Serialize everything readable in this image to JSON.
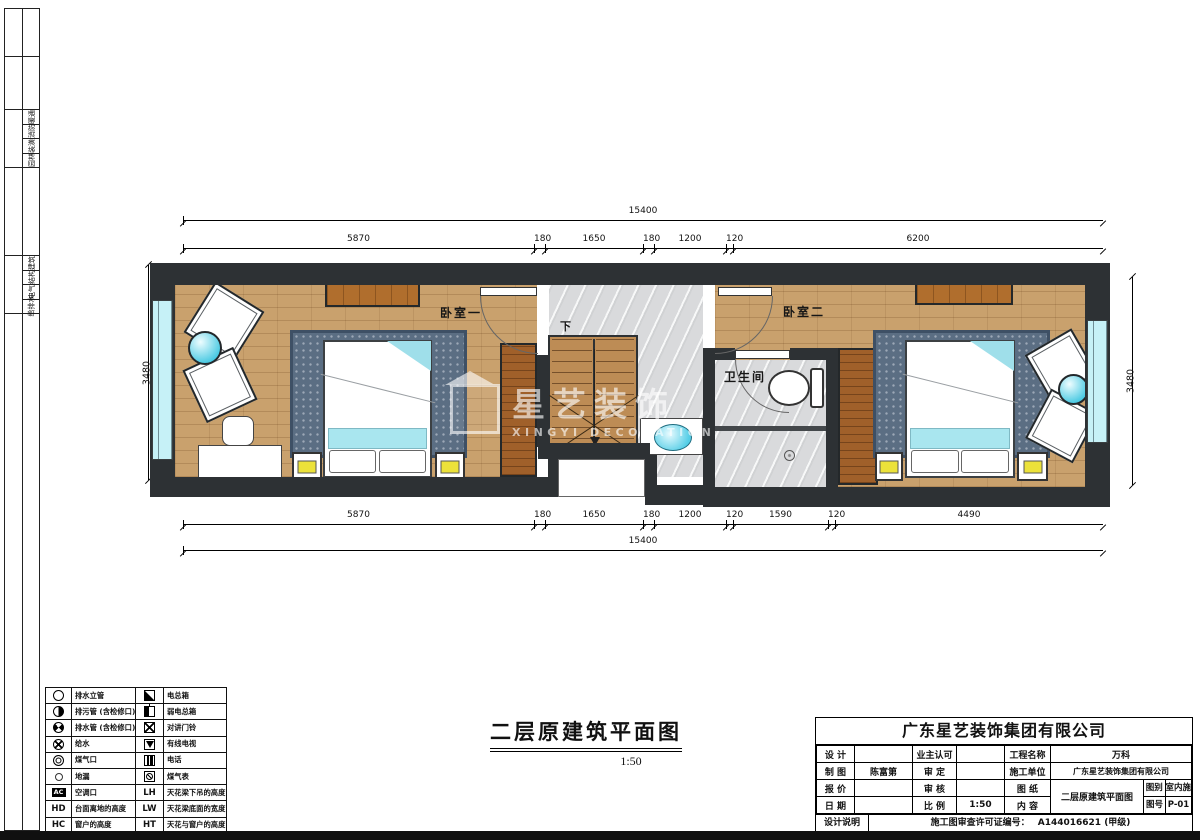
{
  "sheet": {
    "disciplines_top": [
      "暖通",
      "消防",
      "装潢",
      "园林"
    ],
    "disciplines_bottom": [
      "建筑",
      "结构",
      "电气",
      "给排水"
    ]
  },
  "plan": {
    "room1": "卧室一",
    "room2": "卧室二",
    "bath": "卫生间",
    "stair_down": "下",
    "dims": {
      "top_overall": "15400",
      "top_segments": [
        "5870",
        "180",
        "1650",
        "180",
        "1200",
        "120",
        "6200"
      ],
      "bottom_segments": [
        "5870",
        "180",
        "1650",
        "180",
        "1200",
        "120",
        "1590",
        "120",
        "4490"
      ],
      "bottom_overall": "15400",
      "left": "3480",
      "right": "3480"
    }
  },
  "watermark": {
    "cn": "星艺装饰",
    "en": "XINGYI DECORATION"
  },
  "drawing_title": {
    "text": "二层原建筑平面图",
    "scale": "1:50"
  },
  "colors": {
    "wall": "#2d3134",
    "wood": "#c9a16d",
    "marble": "#d9dadc",
    "window": "#c6f1f7",
    "rug": "#5b6e83",
    "accent_cyan": "#9fdfea",
    "lamp_yellow": "#ece23a"
  },
  "legend": {
    "rows": [
      {
        "sym1": "drain-riser",
        "t1": "排水立管",
        "sym2": "power-box",
        "t2": "电总箱"
      },
      {
        "sym1": "sewage-pipe",
        "t1": "排污管 (含检修口)",
        "sym2": "weak-power-box",
        "t2": "弱电总箱"
      },
      {
        "sym1": "drain-pipe",
        "t1": "排水管 (含检修口)",
        "sym2": "door-bell",
        "t2": "对讲门铃"
      },
      {
        "sym1": "water-supply",
        "t1": "给水",
        "sym2": "cable-tv",
        "t2": "有线电视"
      },
      {
        "sym1": "gas-port",
        "t1": "煤气口",
        "sym2": "telephone",
        "t2": "电话"
      },
      {
        "sym1": "floor-drain",
        "t1": "地漏",
        "sym2": "gas-meter",
        "t2": "煤气表"
      },
      {
        "c1": "AC",
        "t1": "空调口",
        "c2": "LH",
        "t2": "天花梁下吊的高度"
      },
      {
        "c1": "HD",
        "t1": "台面离地的高度",
        "c2": "LW",
        "t2": "天花梁底面的宽度"
      },
      {
        "c1": "HC",
        "t1": "窗户的高度",
        "c2": "HT",
        "t2": "天花与窗户的高度"
      }
    ]
  },
  "titleblock": {
    "company": "广东星艺装饰集团有限公司",
    "design_label": "设 计",
    "design_value": "",
    "owner_label": "业主认可",
    "owner_value": "",
    "project_label": "工程名称",
    "project_value": "万科",
    "draft_label": "制 图",
    "draft_value": "陈富第",
    "approve_label": "审 定",
    "approve_value": "",
    "contractor_label": "施工单位",
    "contractor_value": "广东星艺装饰集团有限公司",
    "quote_label": "报 价",
    "quote_value": "",
    "check_label": "审 核",
    "check_value": "",
    "sheet_label": "图 纸",
    "content_label": "内 容",
    "content_value": "二层原建筑平面图",
    "date_label": "日 期",
    "date_value": "",
    "scale_label": "比 例",
    "scale_value": "1:50",
    "category_label": "图别",
    "category_value": "室内施",
    "number_label": "图号",
    "number_value": "P-01",
    "note_label": "设计说明",
    "permit_label": "施工图审查许可证编号：",
    "permit_value": "A144016621 (甲级)"
  }
}
